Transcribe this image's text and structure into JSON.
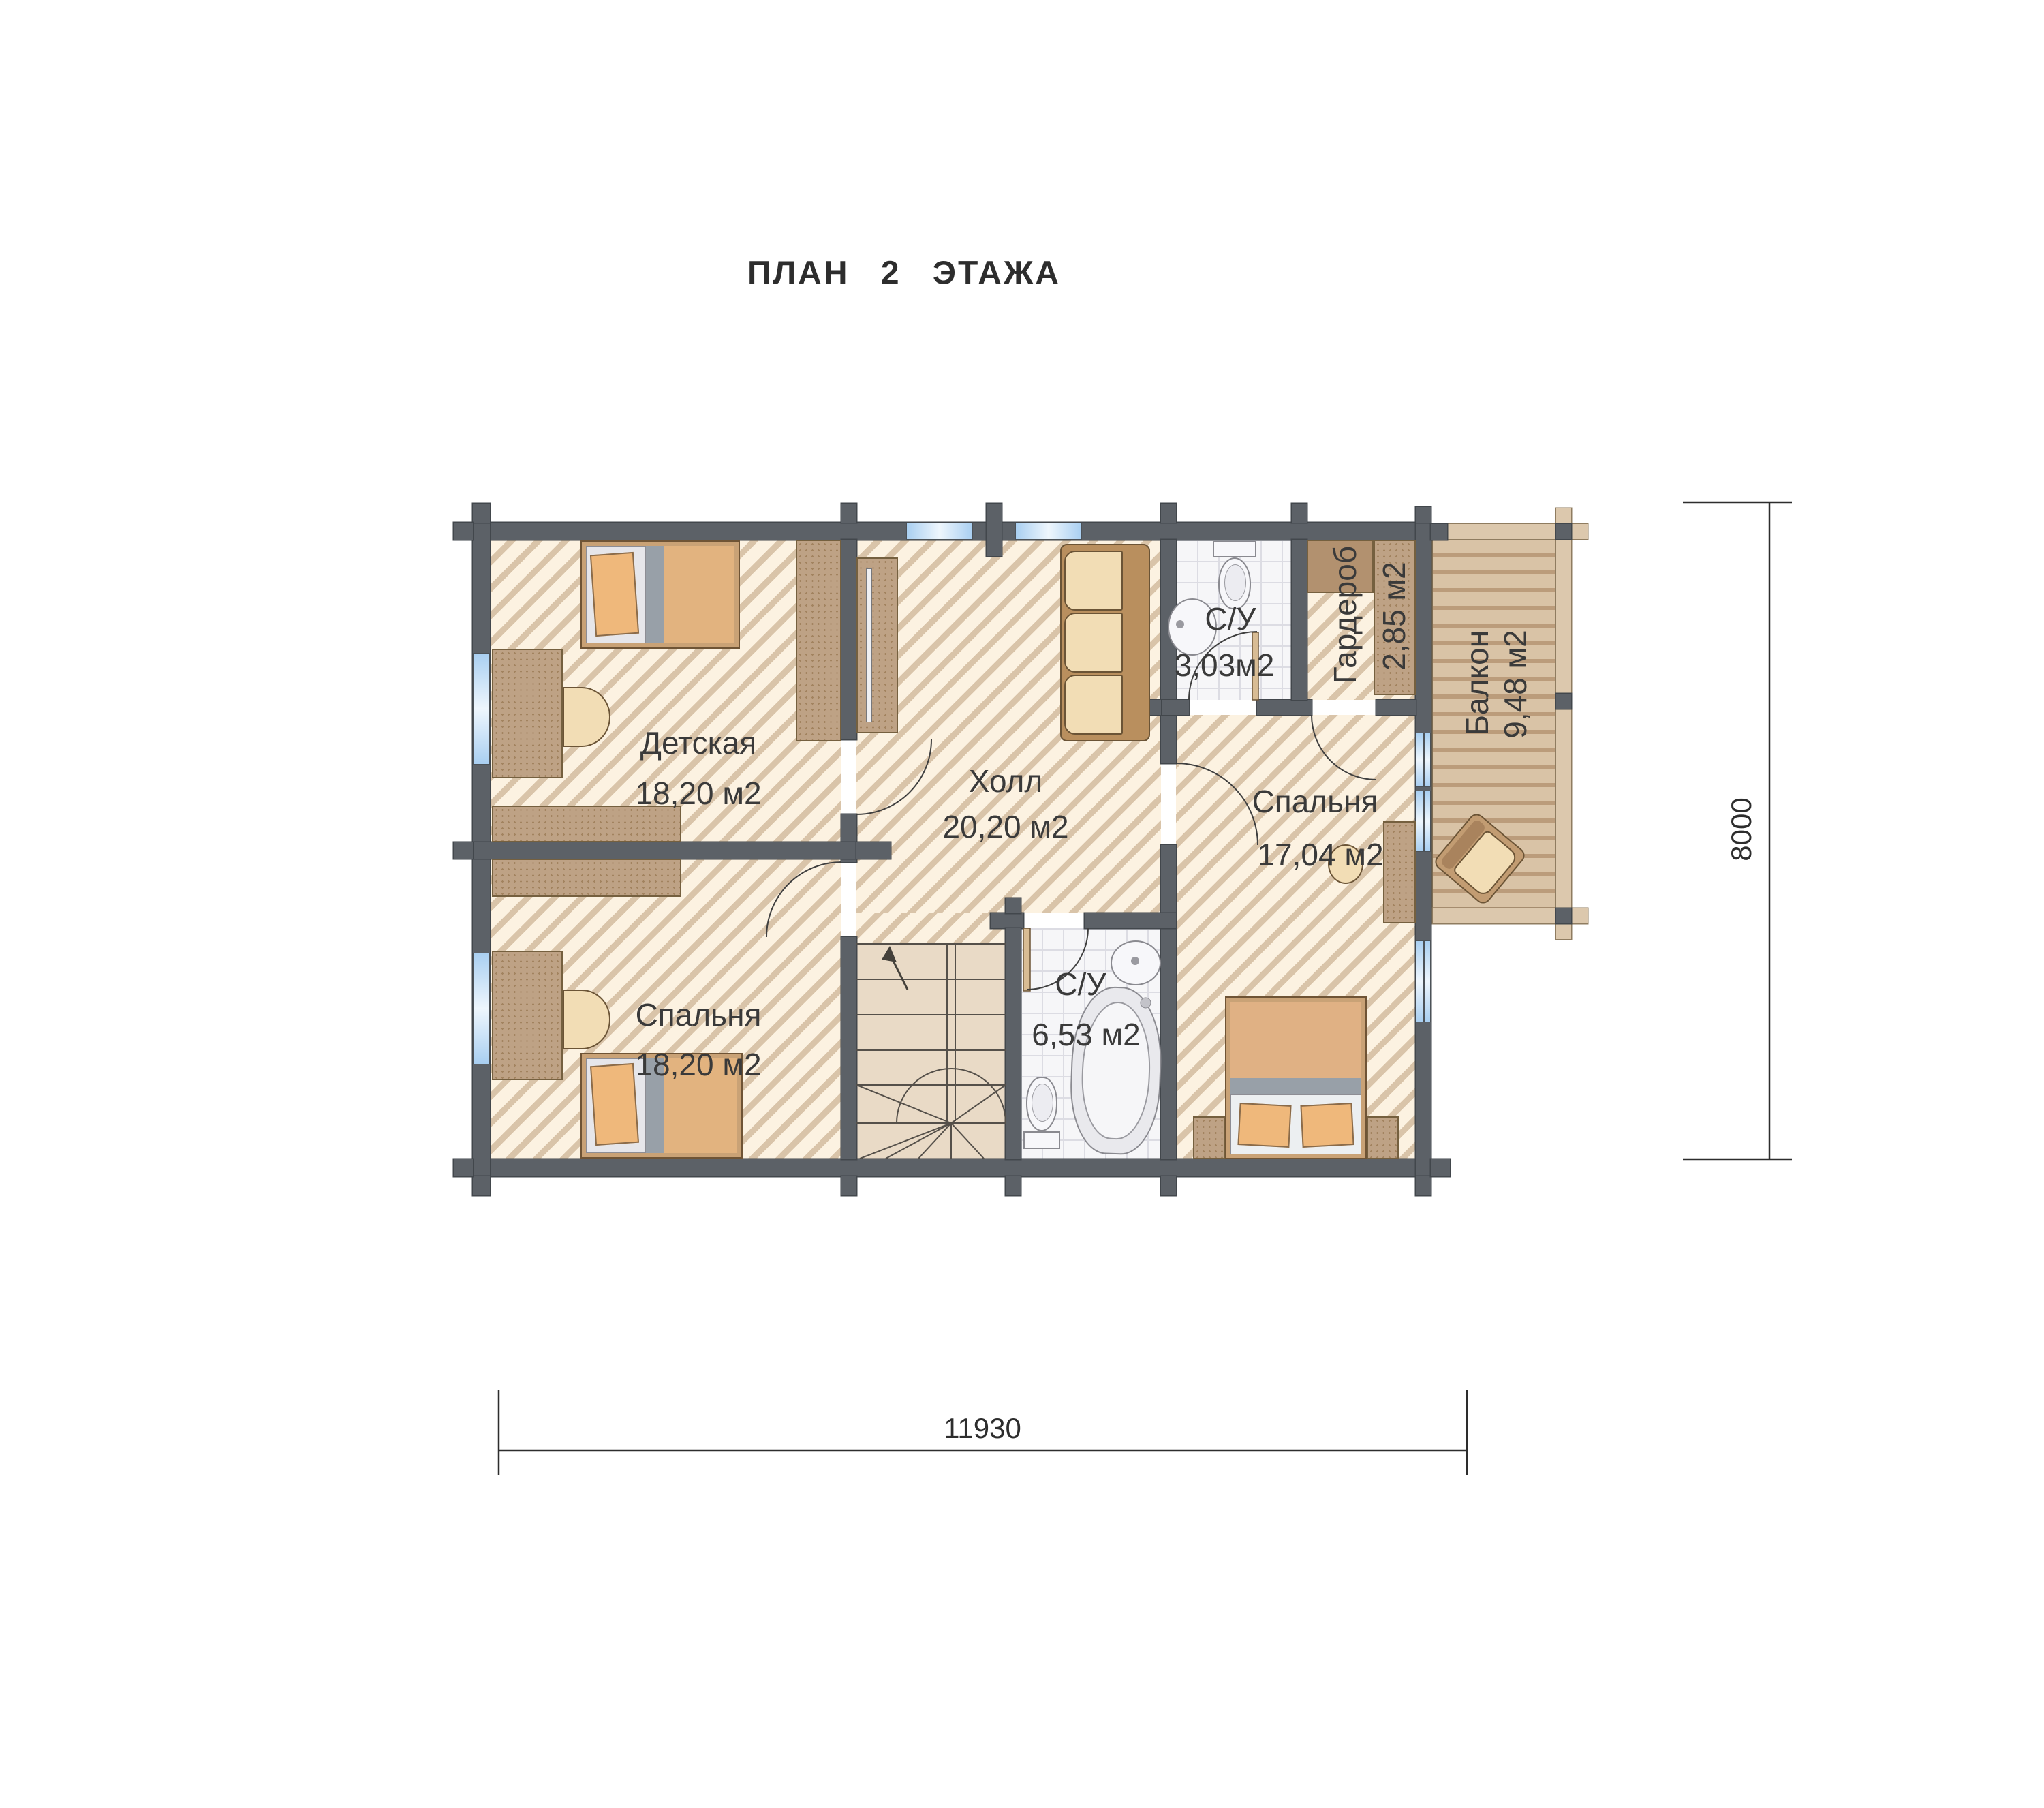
{
  "title": "ПЛАН  2  ЭТАЖА",
  "rooms": {
    "nursery": {
      "name": "Детская",
      "area": "18,20  м2"
    },
    "bedroom_left": {
      "name": "Спальня",
      "area": "18,20  м2"
    },
    "hall": {
      "name": "Холл",
      "area": "20,20  м2"
    },
    "bathroom_top": {
      "name": "С/У",
      "area": "3,03м2"
    },
    "wardrobe": {
      "name": "Гардероб",
      "area": "2,85  м2"
    },
    "balcony": {
      "name": "Балкон",
      "area": "9,48  м2"
    },
    "bedroom_right": {
      "name": "Спальня",
      "area": "17,04  м2"
    },
    "bathroom_bottom": {
      "name": "С/У",
      "area": "6,53  м2"
    }
  },
  "dimensions": {
    "width_mm": "11930",
    "height_mm": "8000"
  },
  "colors": {
    "wall": "#5c6167",
    "floor": "#fcf2e1",
    "hatch": "#d9c4a9",
    "tile": "#f6f6f8",
    "deck": "#d9c3a6",
    "window": "#a9cff1",
    "furniture": "#bea285",
    "cushion": "#f2ddb5",
    "mattress": "#e0b184",
    "text": "#3a3a3a"
  }
}
